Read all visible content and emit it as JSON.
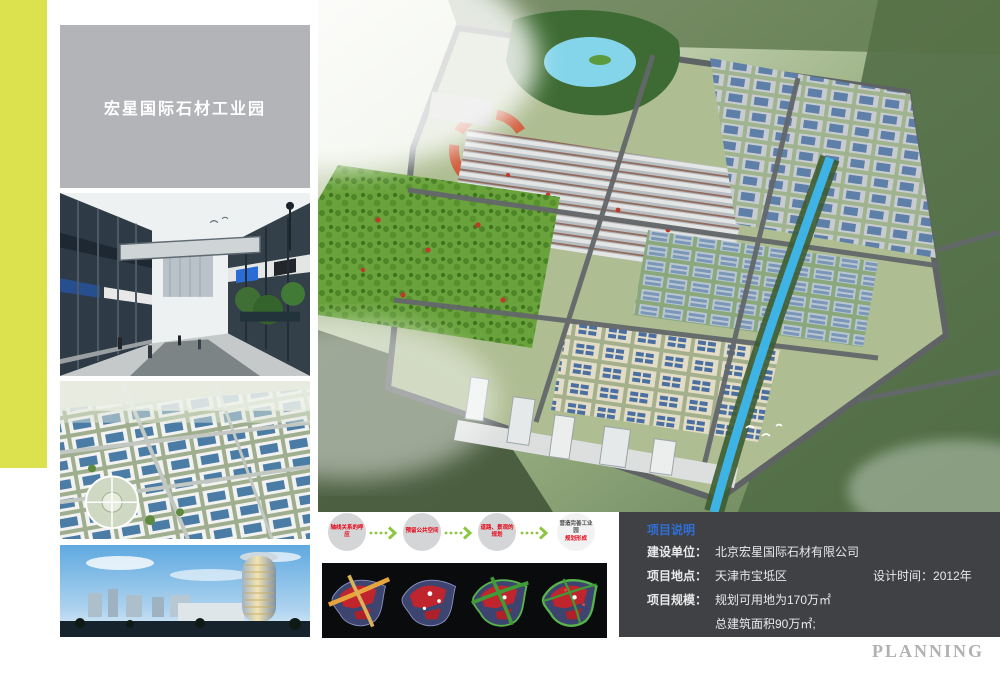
{
  "title_panel": {
    "label": "宏星国际石材工业园"
  },
  "thumbnails": [
    {
      "name": "street-view-render"
    },
    {
      "name": "aerial-park-render"
    },
    {
      "name": "tower-dusk-render"
    }
  ],
  "master_plan": {
    "name": "master-plan-aerial-render"
  },
  "process_flow": {
    "steps": [
      {
        "label": "轴线关系的呼应"
      },
      {
        "label": "预留公共空间"
      },
      {
        "label": "道路、景观的规划"
      },
      {
        "label": "营造完善工业园",
        "sublabel": "规划形成"
      }
    ]
  },
  "concept_diagrams": [
    {
      "name": "axis-overlay-diagram"
    },
    {
      "name": "node-points-diagram"
    },
    {
      "name": "road-network-diagram"
    },
    {
      "name": "final-plan-diagram"
    }
  ],
  "project_info": {
    "title": "项目说明",
    "rows": [
      {
        "label": "建设单位：",
        "value": "北京宏星国际石材有限公司",
        "extra_label": "",
        "extra_value": ""
      },
      {
        "label": "项目地点：",
        "value": "天津市宝坻区",
        "extra_label": "设计时间：",
        "extra_value": "2012年"
      },
      {
        "label": "项目规模：",
        "value": "规划可用地为170万㎡",
        "extra_label": "",
        "extra_value": ""
      },
      {
        "label": "",
        "value": "总建筑面积90万㎡;",
        "extra_label": "",
        "extra_value": ""
      }
    ]
  },
  "footer": {
    "watermark": "PLANNING"
  },
  "colors": {
    "accent_stripe": "#dce24e",
    "title_panel_bg": "#b2b4b7",
    "info_box_bg": "#3f4145",
    "info_title_blue": "#2f6fd6",
    "flow_text_red": "#e60012",
    "flow_arrow_green": "#8cc63e",
    "flow_circle_gray": "#d4d5d7",
    "watermark_gray": "#b1b1b1",
    "concept_panel_bg": "#0a0b0d"
  }
}
